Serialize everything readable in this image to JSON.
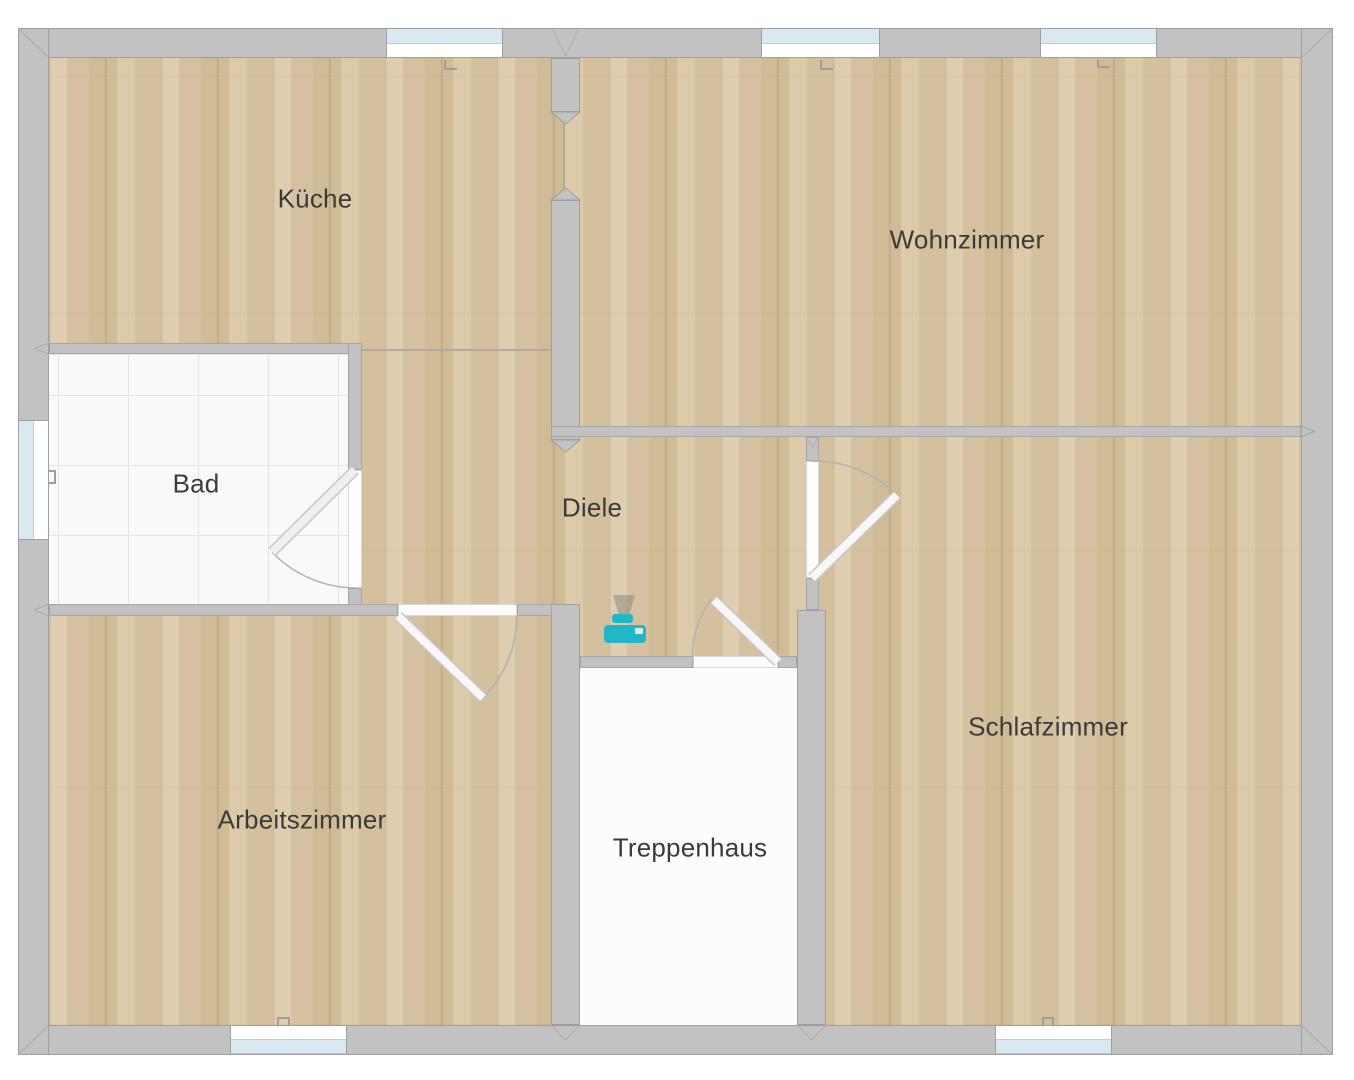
{
  "plan": {
    "type": "floor-plan",
    "canvas": {
      "width": 1354,
      "height": 1080
    }
  },
  "rooms": [
    {
      "id": "kueche",
      "label": "Küche",
      "floor": "wood",
      "label_center": {
        "x": 315,
        "y": 199
      }
    },
    {
      "id": "wohnzimmer",
      "label": "Wohnzimmer",
      "floor": "wood",
      "label_center": {
        "x": 967,
        "y": 240
      }
    },
    {
      "id": "bad",
      "label": "Bad",
      "floor": "tile",
      "label_center": {
        "x": 196,
        "y": 484
      }
    },
    {
      "id": "diele",
      "label": "Diele",
      "floor": "wood",
      "label_center": {
        "x": 592,
        "y": 508
      }
    },
    {
      "id": "arbeitszimmer",
      "label": "Arbeitszimmer",
      "floor": "wood",
      "label_center": {
        "x": 302,
        "y": 820
      }
    },
    {
      "id": "treppenhaus",
      "label": "Treppenhaus",
      "floor": "plain",
      "label_center": {
        "x": 690,
        "y": 848
      }
    },
    {
      "id": "schlafzimmer",
      "label": "Schlafzimmer",
      "floor": "wood",
      "label_center": {
        "x": 1048,
        "y": 727
      }
    }
  ],
  "windows": [
    {
      "room": "Küche",
      "wall": "top",
      "x": 386,
      "width": 117
    },
    {
      "room": "Wohnzimmer",
      "wall": "top",
      "x": 761,
      "width": 119
    },
    {
      "room": "Wohnzimmer",
      "wall": "top",
      "x": 1040,
      "width": 117
    },
    {
      "room": "Bad",
      "wall": "left",
      "y": 420,
      "height": 120
    },
    {
      "room": "Arbeitszimmer",
      "wall": "bottom",
      "x": 230,
      "width": 117
    },
    {
      "room": "Schlafzimmer",
      "wall": "bottom",
      "x": 995,
      "width": 117
    }
  ],
  "doors": [
    {
      "from": "Diele",
      "to": "Arbeitszimmer",
      "hinge": "left",
      "swing": "into Arbeitszimmer"
    },
    {
      "from": "Diele",
      "to": "Treppenhaus",
      "hinge": "right",
      "swing": "into Diele"
    },
    {
      "from": "Diele",
      "to": "Schlafzimmer",
      "hinge": "bottom",
      "swing": "into Schlafzimmer"
    },
    {
      "from": "Diele",
      "to": "Bad",
      "hinge": "top",
      "swing": "into Bad"
    }
  ],
  "openings": [
    {
      "between": [
        "Küche",
        "Wohnzimmer"
      ],
      "type": "open passage"
    }
  ],
  "icons": [
    {
      "name": "printer-icon",
      "room": "Diele",
      "x": 604,
      "y": 595,
      "color": "#22b6c9"
    }
  ],
  "colors": {
    "wall": "#c2c2c2",
    "wall_outline": "#9f9f9f",
    "wood_floor": "#d9c5a2",
    "tile_floor": "#f9f9f9",
    "staircase_floor": "#fcfcfc",
    "window_glass": "#d8e9ef",
    "door_leaf": "#f7f7f7",
    "accent_teal": "#22b6c9",
    "label_text": "#3b3b3b",
    "background": "#ffffff"
  }
}
